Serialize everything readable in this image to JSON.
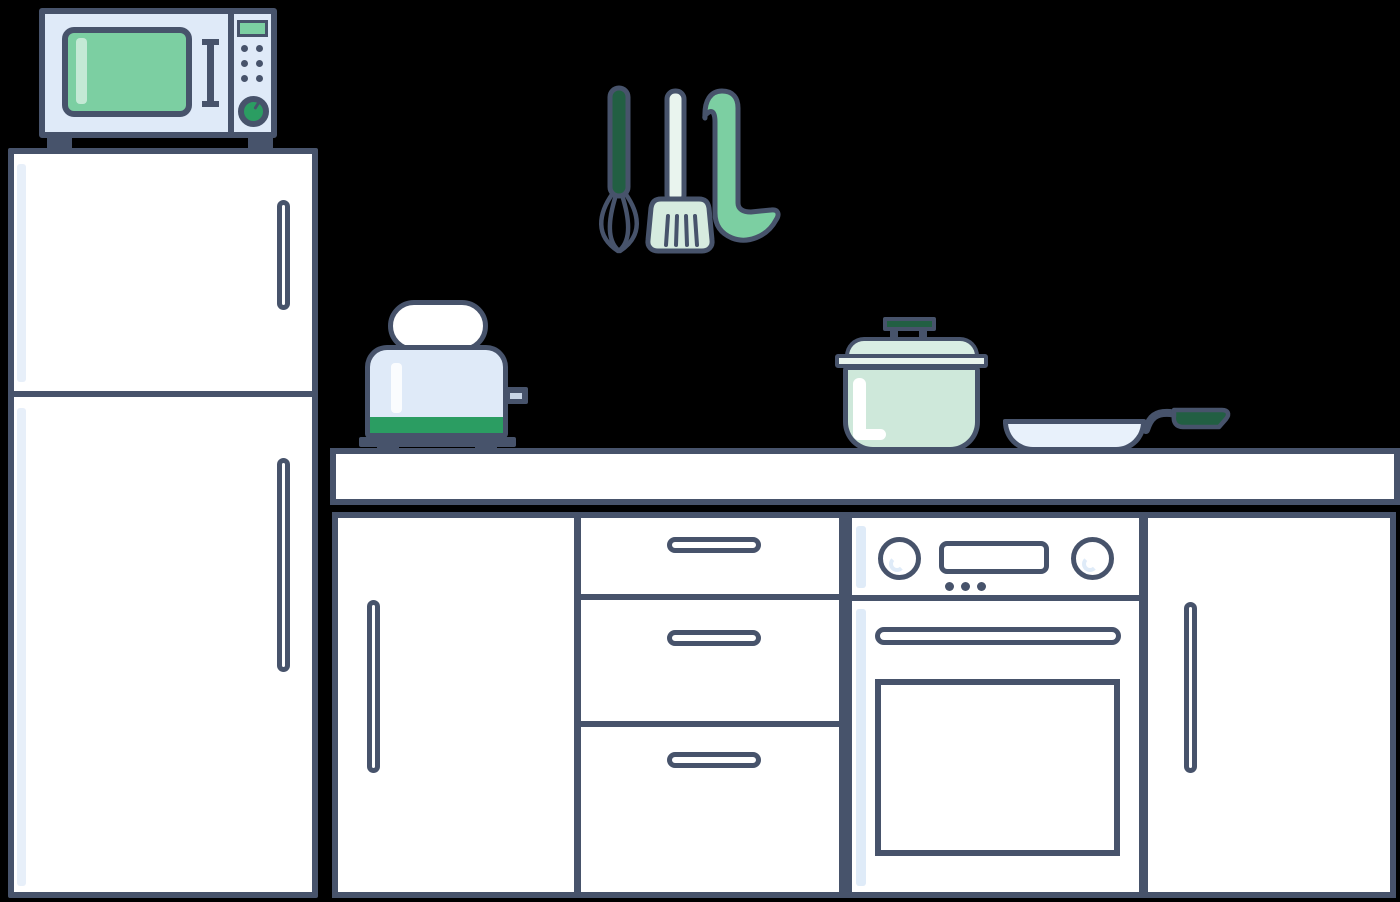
{
  "title": "Flat-style kitchen illustration on black background",
  "scene": {
    "background": "#000000",
    "outline": "#47536B",
    "palette": {
      "white": "#FFFFFF",
      "appliance_blue": "#DFEAF8",
      "highlight_blue": "#DFEBF8",
      "pan_blue": "#E8F1FB",
      "mint_green": "#7CCFA2",
      "pot_mint": "#CEE8DA",
      "lid_mint": "#D8EDE3",
      "spatula_mint": "#D6EBDF",
      "pale_mint": "#E9F4EE",
      "green": "#2B9D62",
      "dark_green": "#225F43"
    },
    "objects": {
      "microwave": {
        "location": "on top of refrigerator",
        "buttons": 6,
        "has_display": true,
        "has_knob": true
      },
      "refrigerator": {
        "doors": 2,
        "handles": 2
      },
      "hanging_utensils": [
        "whisk",
        "slotted-spatula",
        "ladle"
      ],
      "toaster": {
        "bread_slices": 1,
        "has_lever": true
      },
      "pot": {
        "has_lid": true
      },
      "frying_pan": {
        "has_handle": true
      },
      "countertop": 1,
      "lower_cabinets": {
        "doors": 2,
        "drawers": 3,
        "oven": {
          "knobs": 2,
          "display": true,
          "indicator_dots": 3,
          "door_window": true
        }
      }
    }
  }
}
